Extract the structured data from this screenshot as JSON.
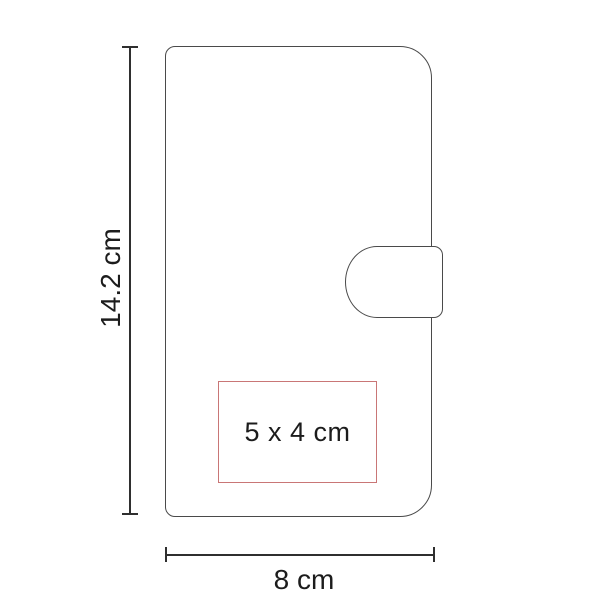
{
  "diagram": {
    "type": "product-dimension-diagram",
    "product_shape": "wallet-with-clasp",
    "height_dimension": {
      "label": "14.2 cm"
    },
    "width_dimension": {
      "label": "8 cm"
    },
    "imprint_area": {
      "label": "5 x 4 cm"
    },
    "colors": {
      "background": "#ffffff",
      "outline": "#4a4a4a",
      "dimension_line": "#2f2f2f",
      "text": "#1c1c1c",
      "imprint_border": "#c97676"
    }
  }
}
